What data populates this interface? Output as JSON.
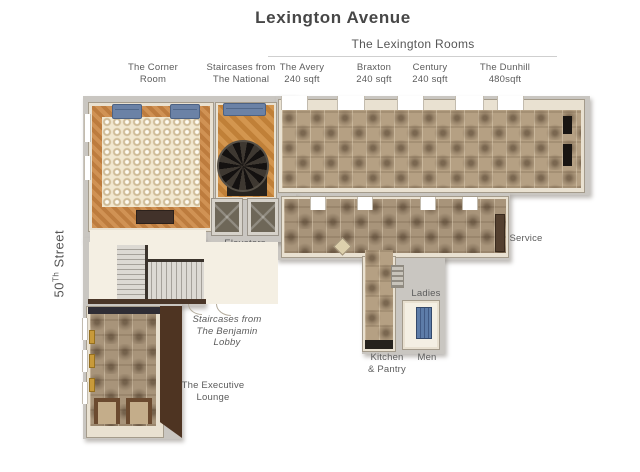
{
  "header": {
    "title": "Lexington Avenue",
    "subtitle": "The Lexington Rooms"
  },
  "street": {
    "number": "50",
    "sup": "Th",
    "rest": " Street"
  },
  "room_labels": {
    "corner": {
      "line1": "The Corner",
      "line2": "Room"
    },
    "national": {
      "line1": "Staircases from",
      "line2": "The National"
    },
    "avery": {
      "line1": "The Avery",
      "line2": "240 sqft"
    },
    "braxton": {
      "line1": "Braxton",
      "line2": "240 sqft"
    },
    "century": {
      "line1": "Century",
      "line2": "240 sqft"
    },
    "dunhill": {
      "line1": "The Dunhill",
      "line2": "480sqft"
    }
  },
  "plan_labels": {
    "elevators": "Elevators",
    "service": "Service",
    "ladies": "Ladies",
    "kitchen_line1": "Kitchen",
    "kitchen_line2": "& Pantry",
    "men": "Men",
    "benjamin_line1": "Staircases from",
    "benjamin_line2": "The Benjamin",
    "benjamin_line3": "Lobby",
    "executive_line1": "The Executive",
    "executive_line2": "Lounge"
  },
  "colors": {
    "carpet_tan": "#b5a083",
    "carpet_motif": "#6e5a44",
    "carpet_cream": "#f1e7cf",
    "wood_parquet": "#c98c4a",
    "wall_cream": "#e9e1d1",
    "slab_gray": "#c9c6c1",
    "sofa_blue": "#6b82a6",
    "stall_blue": "#5d7ca8",
    "dark_wood_wall": "#4e3422",
    "label_gray": "#5c5c5c"
  }
}
